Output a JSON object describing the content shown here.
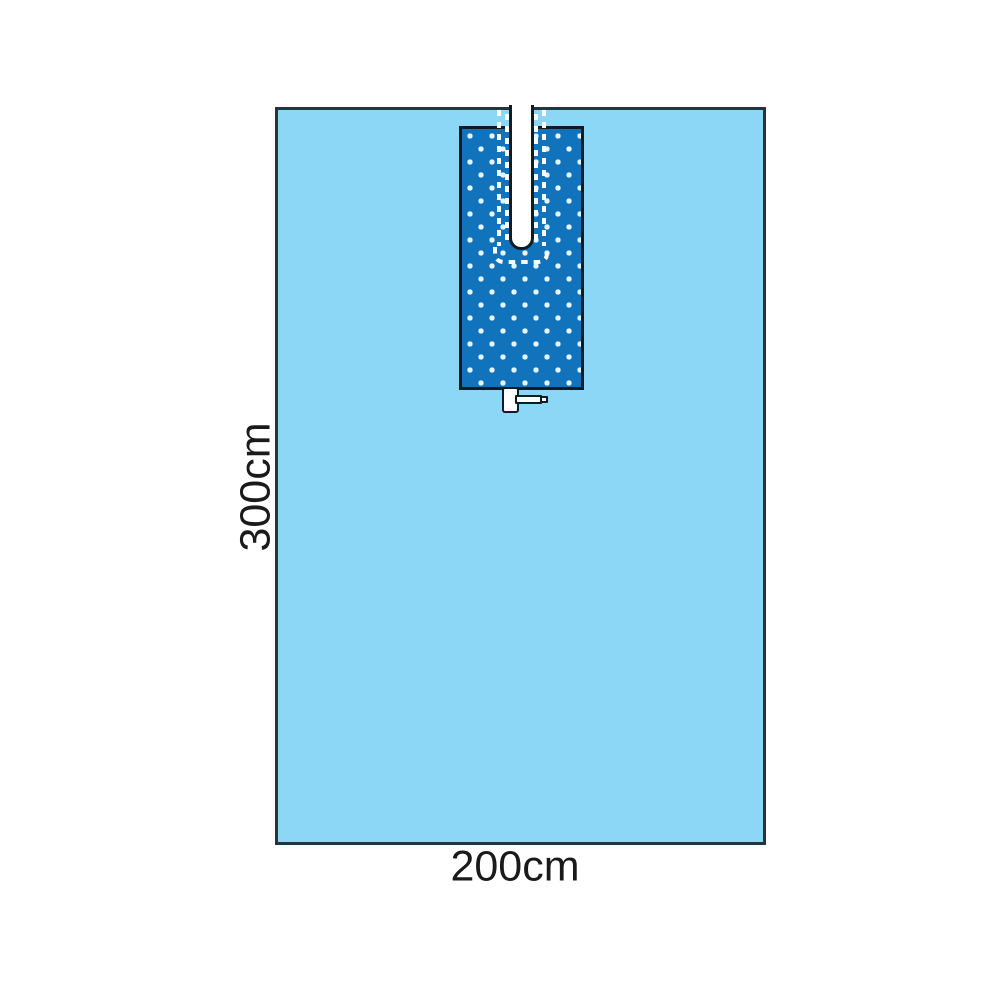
{
  "diagram": {
    "labels": {
      "height": "300cm",
      "width": "200cm"
    },
    "colors": {
      "background": "#ffffff",
      "drape_fill": "#8cd6f6",
      "panel_fill": "#1173bb",
      "panel_dot": "#e6f5fd",
      "outline_dark": "#101c23",
      "drape_outline": "#24343d",
      "adhesive_dash": "#ffffff",
      "label_text": "#1a1a1a"
    },
    "shapes": {
      "drape": "surgical-drape-sheet",
      "panel": "dotted-reinforcement-panel",
      "slit": "top-center-slit-opening",
      "dashes": "adhesive-dashed-outline",
      "tab": "tube-holder-tab"
    }
  }
}
